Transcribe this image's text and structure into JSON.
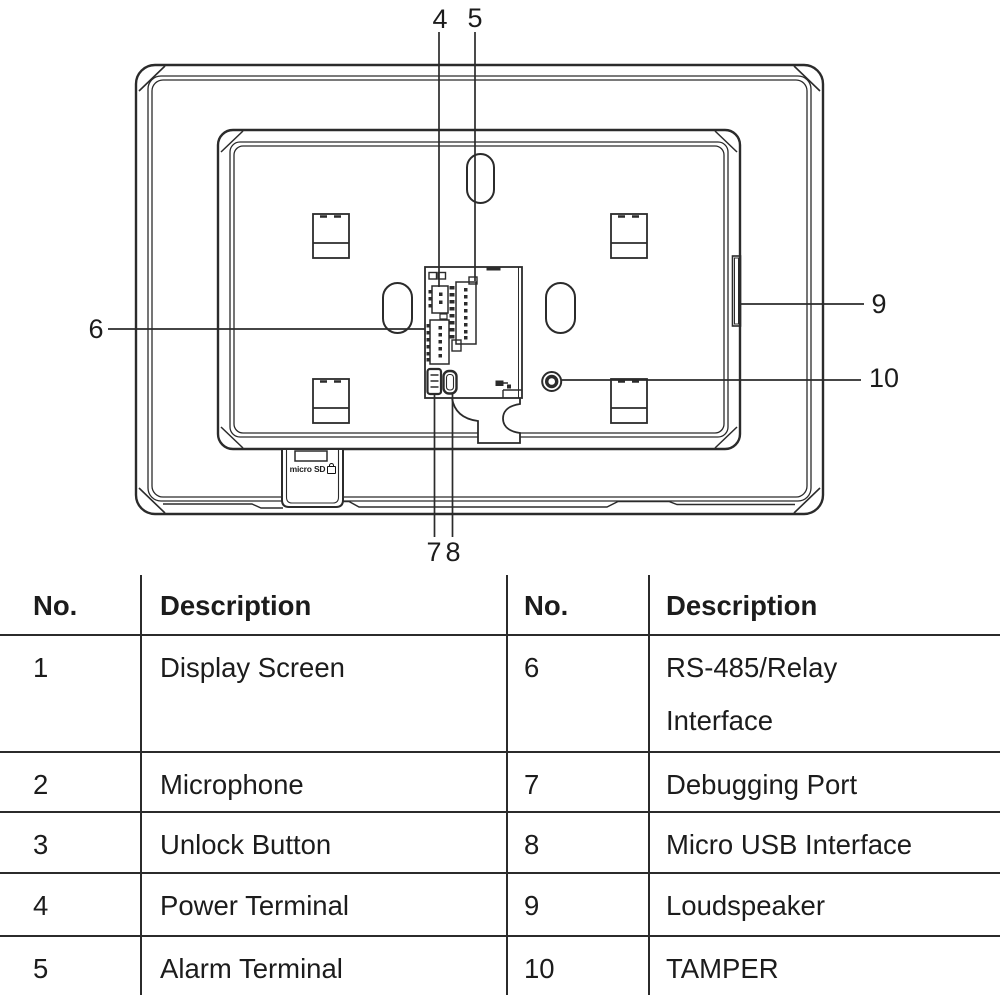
{
  "diagram": {
    "callouts": {
      "c4": "4",
      "c5": "5",
      "c6": "6",
      "c7": "7",
      "c8": "8",
      "c9": "9",
      "c10": "10"
    },
    "sd_slot_label": "micro SD"
  },
  "table": {
    "headers": [
      "No.",
      "Description",
      "No.",
      "Description"
    ],
    "rows": [
      [
        "1",
        "Display Screen",
        "6",
        "RS-485/Relay\nInterface"
      ],
      [
        "2",
        "Microphone",
        "7",
        "Debugging Port"
      ],
      [
        "3",
        "Unlock Button",
        "8",
        "Micro USB Interface"
      ],
      [
        "4",
        "Power Terminal",
        "9",
        "Loudspeaker"
      ],
      [
        "5",
        "Alarm Terminal",
        "10",
        "TAMPER"
      ]
    ]
  },
  "colors": {
    "line": "#2b2b2b",
    "text": "#1c1c1c",
    "background": "#ffffff"
  }
}
